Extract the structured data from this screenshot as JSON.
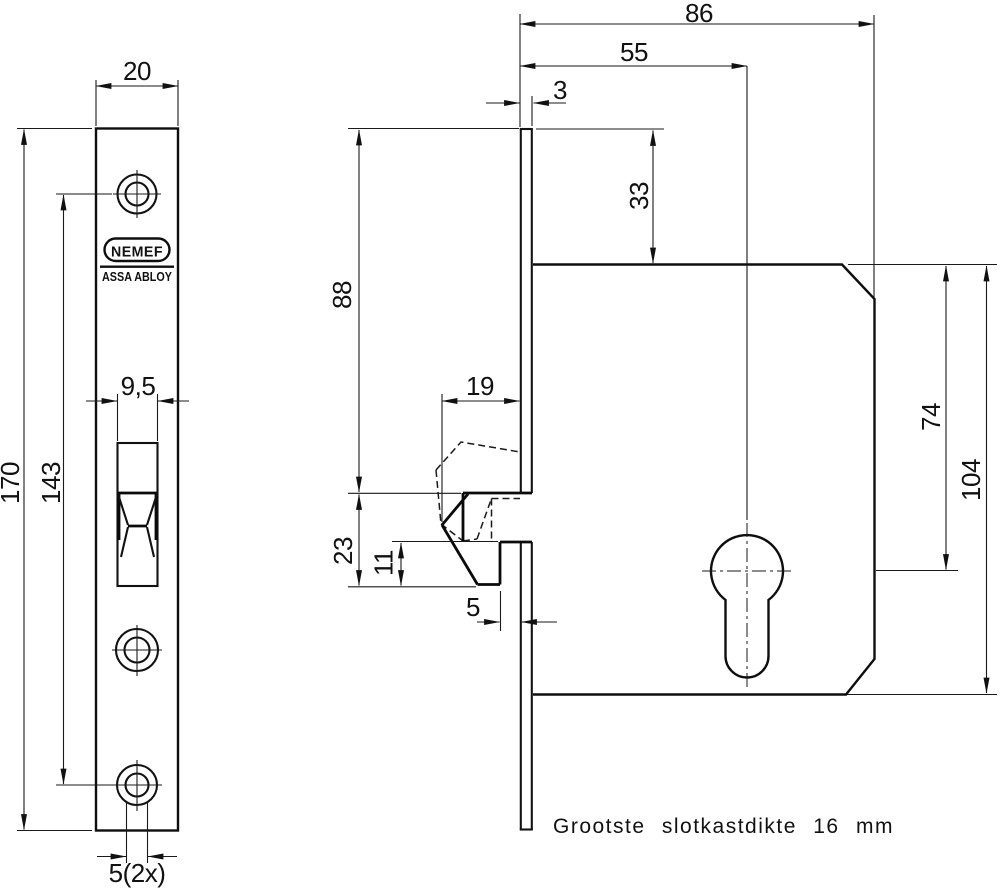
{
  "drawing": {
    "note": "Grootste slotkastdikte 16 mm",
    "brand": {
      "name": "NEMEF",
      "group": "ASSA ABLOY"
    },
    "front_view": {
      "dims": {
        "plate_width": "20",
        "plate_height": "170",
        "screw_hole_span": "143",
        "bolt_cutout_width": "9,5",
        "screw_hole_dia": "5(2x)"
      }
    },
    "side_view": {
      "dims": {
        "total_depth": "86",
        "backset": "55",
        "plate_thickness": "3",
        "case_top_offset": "33",
        "bolt_top_offset": "88",
        "hook_reach": "19",
        "hook_height": "23",
        "notch_height": "11",
        "notch_depth": "5",
        "cylinder_offset": "74",
        "case_height": "104"
      }
    }
  }
}
